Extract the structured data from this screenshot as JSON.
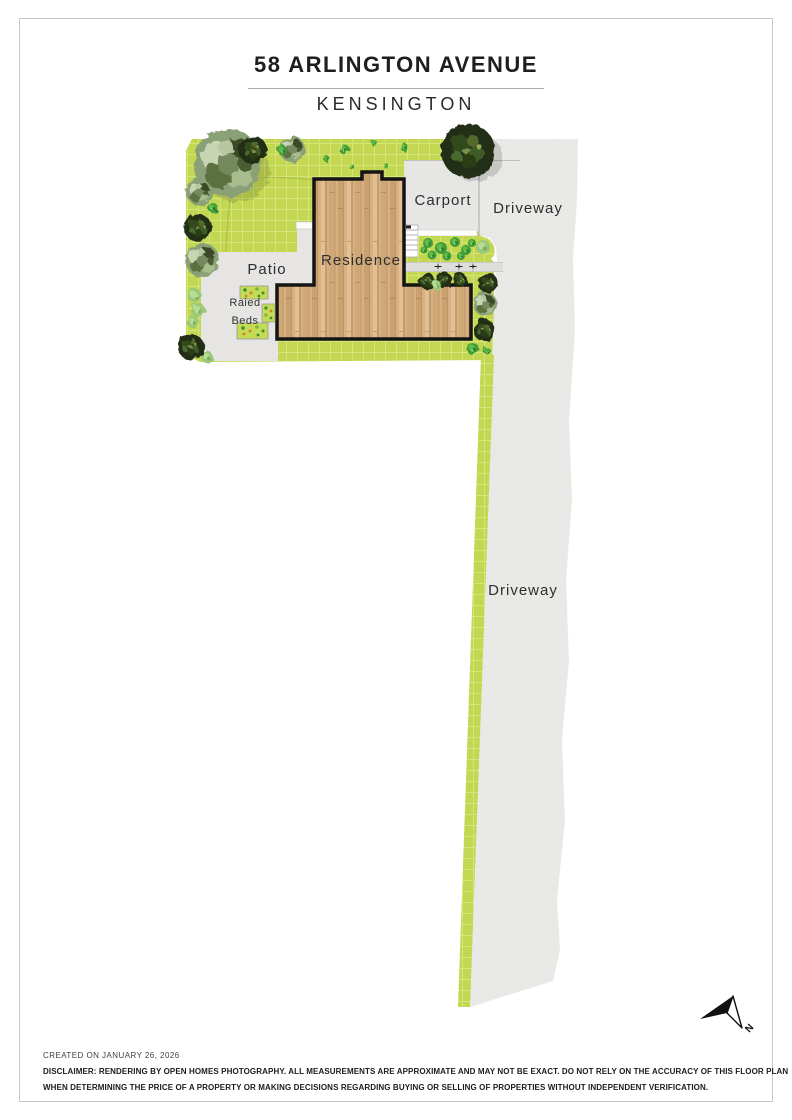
{
  "page": {
    "title": "58 ARLINGTON AVENUE",
    "subtitle": "KENSINGTON",
    "footer": {
      "created": "CREATED ON JANUARY 26, 2026",
      "disclaimer_line1": "DISCLAIMER: RENDERING BY OPEN HOMES PHOTOGRAPHY. ALL MEASUREMENTS ARE APPROXIMATE AND MAY NOT BE EXACT. DO NOT RELY ON THE ACCURACY OF THIS FLOOR PLAN",
      "disclaimer_line2": "WHEN DETERMINING THE PRICE OF A PROPERTY OR MAKING DECISIONS REGARDING BUYING OR SELLING OF PROPERTIES WITHOUT INDEPENDENT VERIFICATION."
    }
  },
  "site_plan": {
    "labels": {
      "residence": "Residence",
      "patio": "Patio",
      "carport": "Carport",
      "driveway_top": "Driveway",
      "driveway_main": "Driveway",
      "raised_beds_line1": "Raied",
      "raised_beds_line2": "Beds"
    },
    "compass": {
      "north_label": "N"
    },
    "colors": {
      "lawn": "#c3d752",
      "lawn_grid": "#dcea85",
      "concrete": "#e7e7e5",
      "paving": "#e6e5e3",
      "wood": "#d6b083",
      "outline": "#141414",
      "tree_dark": "#222e14",
      "tree_sage": "#8aa077",
      "bush_bright": "#3f9e38",
      "bush_light": "#9cc978"
    }
  }
}
